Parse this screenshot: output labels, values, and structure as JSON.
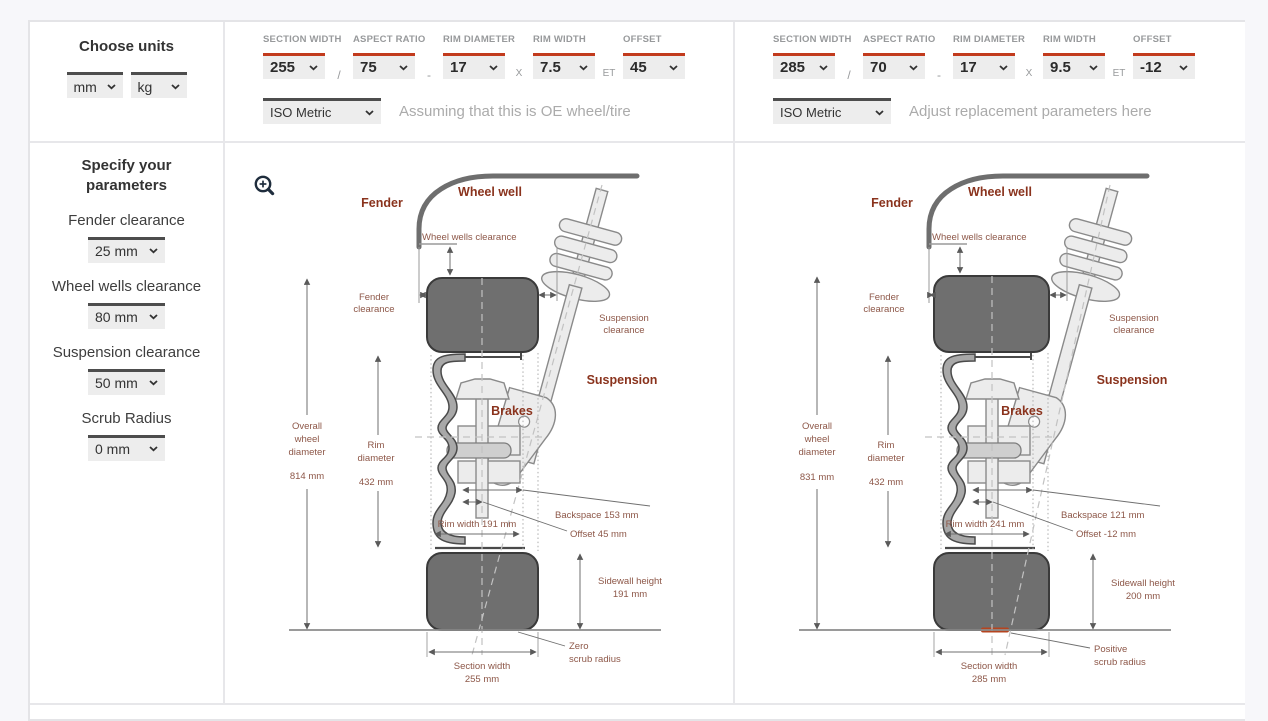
{
  "colors": {
    "accent_red": "#c23b1d",
    "diagram_label_red": "#8a331d",
    "dimension_text": "#8d5748",
    "contact_patch": "#b5441f",
    "tire_fill": "#6f6f6f",
    "page_bg": "#f7f7fa"
  },
  "sidebar": {
    "units_heading": "Choose units",
    "length_unit": "mm",
    "weight_unit": "kg",
    "params_heading_l1": "Specify your",
    "params_heading_l2": "parameters",
    "parameters": [
      {
        "label": "Fender clearance",
        "value": "25 mm"
      },
      {
        "label": "Wheel wells clearance",
        "value": "80 mm"
      },
      {
        "label": "Suspension clearance",
        "value": "50 mm"
      },
      {
        "label": "Scrub Radius",
        "value": "0 mm"
      }
    ]
  },
  "panels": [
    {
      "zoom_icon": "magnifier-plus",
      "fields": [
        {
          "label": "SECTION WIDTH",
          "value": "255"
        },
        {
          "label": "ASPECT RATIO",
          "value": "75"
        },
        {
          "label": "RIM DIAMETER",
          "value": "17"
        },
        {
          "label": "RIM WIDTH",
          "value": "7.5"
        },
        {
          "label": "OFFSET",
          "value": "45"
        }
      ],
      "separators": [
        "/",
        "-",
        "X",
        "ET"
      ],
      "standard": "ISO Metric",
      "hint": "Assuming that this is OE wheel/tire",
      "diagram": {
        "fender": "Fender",
        "wheel_well": "Wheel well",
        "wheel_wells_clearance": "Wheel wells clearance",
        "fender_clearance_l1": "Fender",
        "fender_clearance_l2": "clearance",
        "suspension_clearance_l1": "Suspension",
        "suspension_clearance_l2": "clearance",
        "suspension": "Suspension",
        "brakes": "Brakes",
        "overall_l1": "Overall",
        "overall_l2": "wheel",
        "overall_l3": "diameter",
        "overall_value": "814 mm",
        "rim_d_l1": "Rim",
        "rim_d_l2": "diameter",
        "rim_d_value": "432 mm",
        "backspace": "Backspace 153 mm",
        "offset": "Offset 45 mm",
        "rim_width": "Rim width 191 mm",
        "sidewall_l1": "Sidewall height",
        "sidewall_l2": "191 mm",
        "section_l1": "Section width",
        "section_l2": "255 mm",
        "scrub_l1": "Zero",
        "scrub_l2": "scrub radius"
      }
    },
    {
      "fields": [
        {
          "label": "SECTION WIDTH",
          "value": "285"
        },
        {
          "label": "ASPECT RATIO",
          "value": "70"
        },
        {
          "label": "RIM DIAMETER",
          "value": "17"
        },
        {
          "label": "RIM WIDTH",
          "value": "9.5"
        },
        {
          "label": "OFFSET",
          "value": "-12"
        }
      ],
      "separators": [
        "/",
        "-",
        "X",
        "ET"
      ],
      "standard": "ISO Metric",
      "hint": "Adjust replacement parameters here",
      "diagram": {
        "fender": "Fender",
        "wheel_well": "Wheel well",
        "wheel_wells_clearance": "Wheel wells clearance",
        "fender_clearance_l1": "Fender",
        "fender_clearance_l2": "clearance",
        "suspension_clearance_l1": "Suspension",
        "suspension_clearance_l2": "clearance",
        "suspension": "Suspension",
        "brakes": "Brakes",
        "overall_l1": "Overall",
        "overall_l2": "wheel",
        "overall_l3": "diameter",
        "overall_value": "831 mm",
        "rim_d_l1": "Rim",
        "rim_d_l2": "diameter",
        "rim_d_value": "432 mm",
        "backspace": "Backspace 121 mm",
        "offset": "Offset -12 mm",
        "rim_width": "Rim width 241 mm",
        "sidewall_l1": "Sidewall height",
        "sidewall_l2": "200 mm",
        "section_l1": "Section width",
        "section_l2": "285 mm",
        "scrub_l1": "Positive",
        "scrub_l2": "scrub radius",
        "contact_patch_color": "#b5441f"
      }
    }
  ]
}
